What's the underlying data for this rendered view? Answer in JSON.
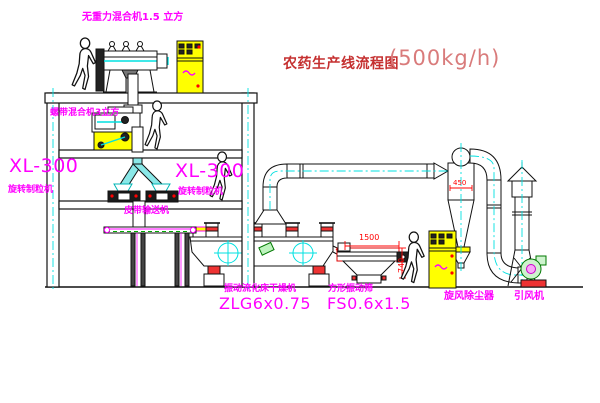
{
  "title": {
    "name_cn": "农药生产线流程图",
    "capacity": "(500kg/h)"
  },
  "equipment_labels": {
    "top_mixer": "无重力混合机1.5 立方",
    "floor2_mixer": "螺带混合机3立方",
    "granulator_left_model": "XL-300",
    "granulator_left_name": "旋转制粒机",
    "granulator_right_model": "XL-300",
    "granulator_right_name": "旋转制粒机",
    "belt_conveyor": "皮带输送机",
    "dryer_name": "振动流化床干燥机",
    "dryer_model": "ZLG6x0.75",
    "screen_name": "方形振动筛",
    "screen_model": "FS0.6x1.5",
    "cyclone": "旋风除尘器",
    "fan": "引风机"
  },
  "dimensions": {
    "screen_length": "1500",
    "screen_height": "740",
    "cyclone_diameter": "450"
  },
  "colors": {
    "label_magenta": "#ff00ff",
    "title_red": "#c53030",
    "capacity_red": "#d97b7b",
    "dimension_red": "#ff0000",
    "centerline_cyan": "#00e0e0",
    "cabinet_yellow": "#ffff00",
    "chute_cyan": "#8ae8e8",
    "fan_green": "#008000"
  }
}
